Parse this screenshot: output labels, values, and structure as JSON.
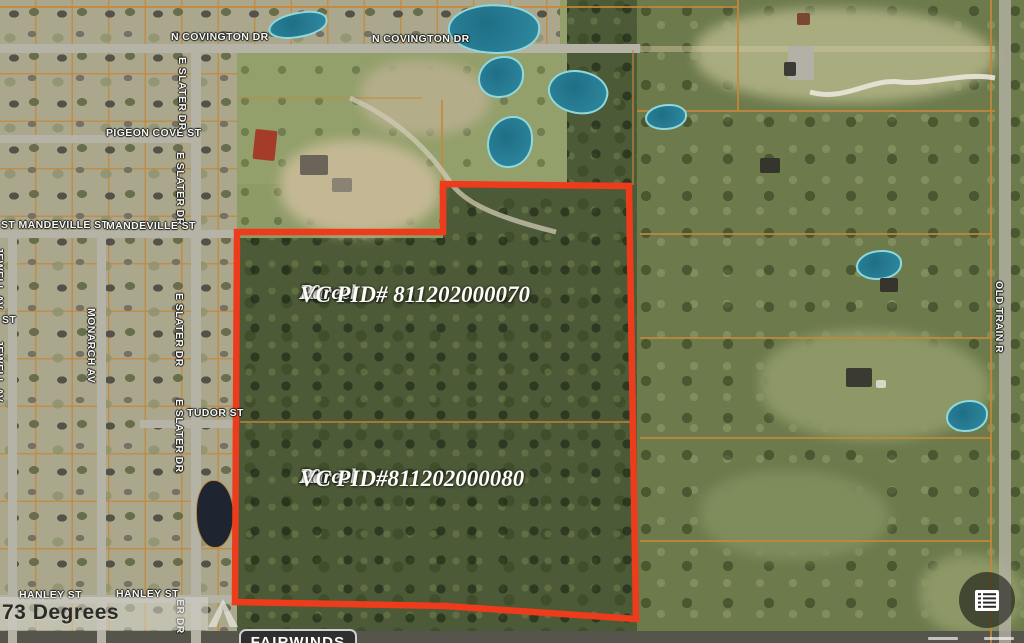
{
  "map": {
    "streets": [
      {
        "id": "n-covington-dr-1",
        "text": "N COVINGTON DR"
      },
      {
        "id": "n-covington-dr-2",
        "text": "N COVINGTON DR"
      },
      {
        "id": "pigeon-cove-st",
        "text": "PIGEON COVE ST"
      },
      {
        "id": "e-slater-dr-1",
        "text": "E SLATER DR"
      },
      {
        "id": "e-slater-dr-2",
        "text": "E SLATER DR"
      },
      {
        "id": "e-slater-dr-3",
        "text": "E SLATER DR"
      },
      {
        "id": "e-slater-dr-4",
        "text": "E SLATER DR"
      },
      {
        "id": "e-slater-dr-5-clipped",
        "text": "ER DR"
      },
      {
        "id": "st-mandeville-st",
        "text": "ST MANDEVILLE ST"
      },
      {
        "id": "mandeville-st",
        "text": "MANDEVILLE ST"
      },
      {
        "id": "monarch-av",
        "text": "MONARCH AV"
      },
      {
        "id": "jewell-av-1",
        "text": "JEWELL AV"
      },
      {
        "id": "jewell-av-2",
        "text": "JEWELL AV"
      },
      {
        "id": "st-fragment",
        "text": "ST"
      },
      {
        "id": "tudor-st",
        "text": "TUDOR ST"
      },
      {
        "id": "hanley-st-1",
        "text": "HANLEY ST"
      },
      {
        "id": "hanley-st-2",
        "text": "HANLEY ST"
      },
      {
        "id": "old-train-r",
        "text": "OLD TRAIN R"
      }
    ],
    "parcels": [
      {
        "line1": "20",
        "line2": "Acre",
        "line3": "Parcel",
        "pid": "VC PID# 811202000070"
      },
      {
        "line1": "20",
        "line2": "Acre",
        "line3": "Parcel",
        "pid": "VC PID#811202000080"
      }
    ],
    "overlay": {
      "degrees_watermark": "73 Degrees",
      "brand_badge": "FAIRWINDS"
    },
    "colors": {
      "parcel_outline": "#ee3b1c",
      "cadastral_line": "#c5873a",
      "water": "#2f8aa0",
      "street_label": "#f7f7f2"
    },
    "icons": {
      "bottom_right_button": "layers-list-icon",
      "watermark_caret": "chevron-up-icon"
    }
  }
}
